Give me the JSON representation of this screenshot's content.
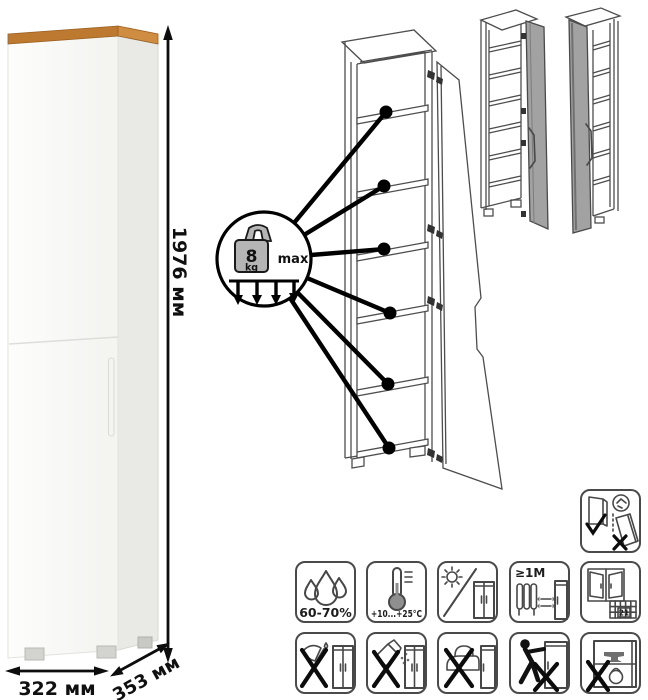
{
  "product": {
    "dimensions": {
      "height": "1976 мм",
      "width": "322 мм",
      "depth": "353 мм"
    }
  },
  "shelf_callout": {
    "weight_value": "8",
    "weight_unit": "kg",
    "max_label": "max"
  },
  "care_icons": {
    "humidity": {
      "label": "60-70%"
    },
    "temperature": {
      "label": "+10...+25°C"
    },
    "no_direct_sunlight": {
      "label": ""
    },
    "heat_source_distance": {
      "label": "≥1М"
    },
    "ventilation": {
      "calendar_day": "21"
    },
    "no_sharp_tools": {
      "label": ""
    },
    "no_abrasive_cleaners": {
      "label": ""
    },
    "no_hot_objects": {
      "label": ""
    },
    "no_dragging": {
      "label": ""
    },
    "no_overloading": {
      "label": ""
    },
    "secure_to_wall": {
      "label": ""
    }
  },
  "colors": {
    "wood_top": "#bd7930",
    "wood_top_light": "#cf8d42",
    "cabinet_white": "#fafaf8",
    "line_art": "#4d4d4d",
    "door_gray": "#a2a2a2",
    "black": "#000000"
  }
}
